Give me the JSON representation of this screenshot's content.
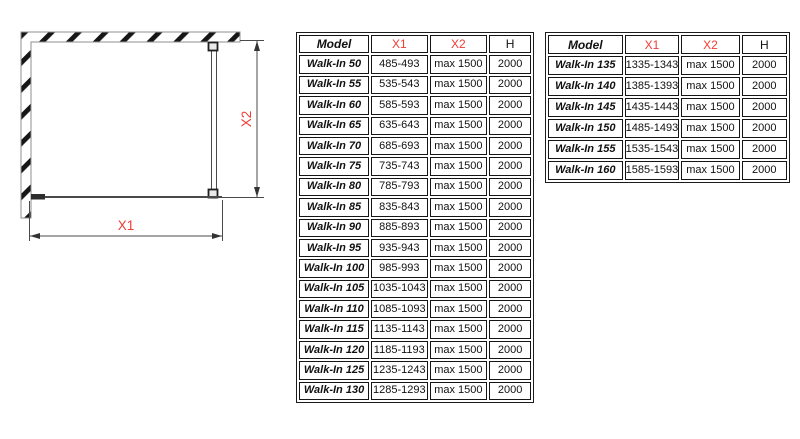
{
  "colors": {
    "accent_red": "#f13c35"
  },
  "diagram": {
    "x1_label": "X1",
    "x2_label": "X2"
  },
  "tables": [
    {
      "name": "walk-in-models-50-130",
      "headers": [
        "Model",
        "X1",
        "X2",
        "H"
      ],
      "rows": [
        [
          "Walk-In 50",
          "485-493",
          "max 1500",
          "2000"
        ],
        [
          "Walk-In 55",
          "535-543",
          "max 1500",
          "2000"
        ],
        [
          "Walk-In 60",
          "585-593",
          "max 1500",
          "2000"
        ],
        [
          "Walk-In 65",
          "635-643",
          "max 1500",
          "2000"
        ],
        [
          "Walk-In 70",
          "685-693",
          "max 1500",
          "2000"
        ],
        [
          "Walk-In 75",
          "735-743",
          "max 1500",
          "2000"
        ],
        [
          "Walk-In 80",
          "785-793",
          "max 1500",
          "2000"
        ],
        [
          "Walk-In 85",
          "835-843",
          "max 1500",
          "2000"
        ],
        [
          "Walk-In 90",
          "885-893",
          "max 1500",
          "2000"
        ],
        [
          "Walk-In 95",
          "935-943",
          "max 1500",
          "2000"
        ],
        [
          "Walk-In 100",
          "985-993",
          "max 1500",
          "2000"
        ],
        [
          "Walk-In 105",
          "1035-1043",
          "max 1500",
          "2000"
        ],
        [
          "Walk-In 110",
          "1085-1093",
          "max 1500",
          "2000"
        ],
        [
          "Walk-In 115",
          "1135-1143",
          "max 1500",
          "2000"
        ],
        [
          "Walk-In 120",
          "1185-1193",
          "max 1500",
          "2000"
        ],
        [
          "Walk-In 125",
          "1235-1243",
          "max 1500",
          "2000"
        ],
        [
          "Walk-In 130",
          "1285-1293",
          "max 1500",
          "2000"
        ]
      ]
    },
    {
      "name": "walk-in-models-135-160",
      "headers": [
        "Model",
        "X1",
        "X2",
        "H"
      ],
      "rows": [
        [
          "Walk-In 135",
          "1335-1343",
          "max 1500",
          "2000"
        ],
        [
          "Walk-In 140",
          "1385-1393",
          "max 1500",
          "2000"
        ],
        [
          "Walk-In 145",
          "1435-1443",
          "max 1500",
          "2000"
        ],
        [
          "Walk-In 150",
          "1485-1493",
          "max 1500",
          "2000"
        ],
        [
          "Walk-In 155",
          "1535-1543",
          "max 1500",
          "2000"
        ],
        [
          "Walk-In 160",
          "1585-1593",
          "max 1500",
          "2000"
        ]
      ]
    }
  ]
}
